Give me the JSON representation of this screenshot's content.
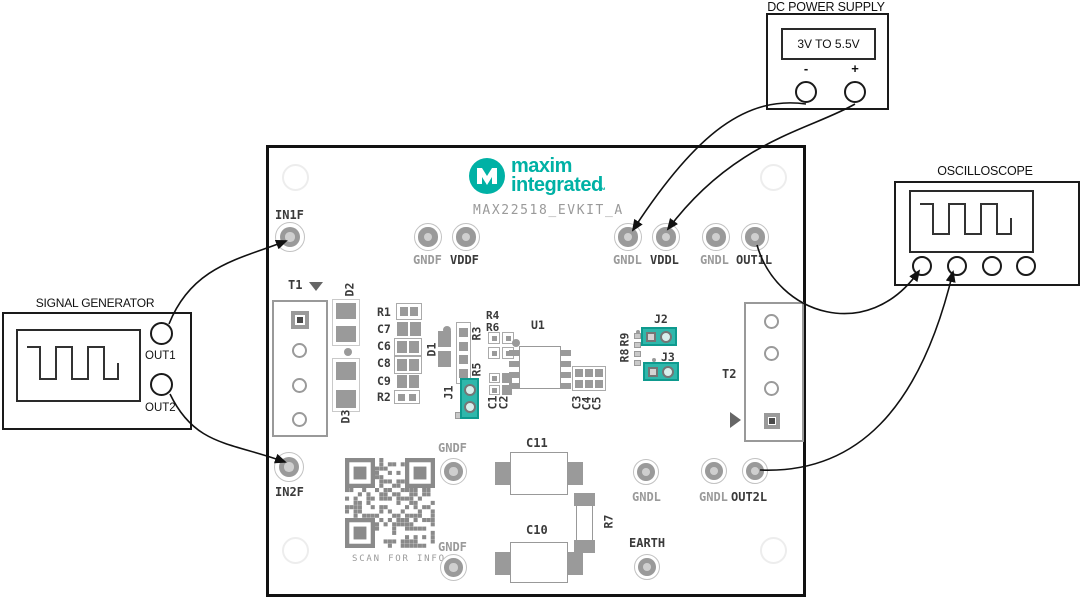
{
  "instruments": {
    "power_supply": {
      "title": "DC POWER SUPPLY",
      "range": "3V TO 5.5V",
      "neg": "-",
      "pos": "+"
    },
    "oscilloscope": {
      "title": "OSCILLOSCOPE"
    },
    "signal_generator": {
      "title": "SIGNAL GENERATOR",
      "out1": "OUT1",
      "out2": "OUT2"
    }
  },
  "board": {
    "brand_line1": "maxim",
    "brand_line2": "integrated",
    "brand_tm": "™",
    "model": "MAX22518_EVKIT_A",
    "qr_caption": "SCAN FOR INFO",
    "labels": {
      "in1f": "IN1F",
      "in2f": "IN2F",
      "gndf_top": "GNDF",
      "vddf": "VDDF",
      "gndl_t1": "GNDL",
      "vddl": "VDDL",
      "gndl_t2": "GNDL",
      "out1l": "OUT1L",
      "gndf_mid": "GNDF",
      "gndf_bot": "GNDF",
      "gndl_b1": "GNDL",
      "earth": "EARTH",
      "gndl_b2": "GNDL",
      "out2l": "OUT2L",
      "t1": "T1",
      "t2": "T2",
      "u1": "U1",
      "r1": "R1",
      "r2": "R2",
      "r3": "R3",
      "r4": "R4",
      "r5": "R5",
      "r6": "R6",
      "r7": "R7",
      "r8": "R8",
      "r9": "R9",
      "c1": "C1",
      "c2": "C2",
      "c3": "C3",
      "c4": "C4",
      "c5": "C5",
      "c6": "C6",
      "c7": "C7",
      "c8": "C8",
      "c9": "C9",
      "c10": "C10",
      "c11": "C11",
      "d1": "D1",
      "d2": "D2",
      "d3": "D3",
      "j1": "J1",
      "j2": "J2",
      "j3": "J3"
    }
  },
  "colors": {
    "teal": "#00B1A5",
    "jumper_fill": "#2FB7AB",
    "jumper_border": "#0E9A8E",
    "silk_gray": "#9A9A9A",
    "silk_dark": "#3A3A3A",
    "qr_gray": "#8A8A8A"
  }
}
